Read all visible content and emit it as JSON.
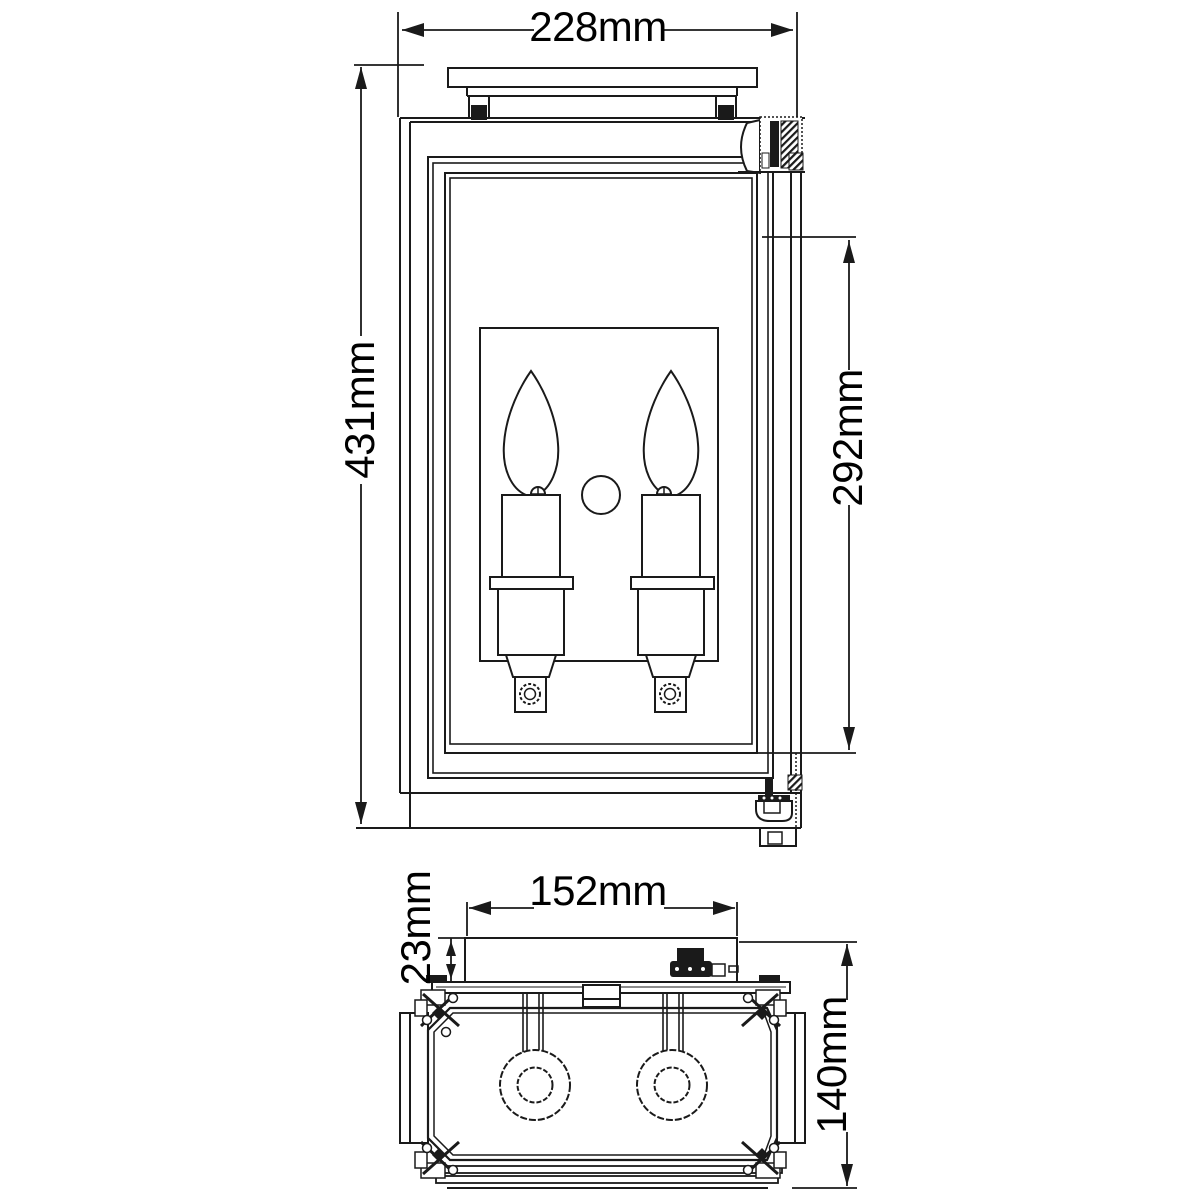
{
  "drawing": {
    "type": "technical-dimension-drawing",
    "subject": "two-light wall lantern fixture",
    "views": {
      "front": {
        "name": "front-elevation",
        "dimensions": [
          {
            "id": "overall_width",
            "label": "228mm",
            "value_mm": 228,
            "orientation": "horizontal"
          },
          {
            "id": "overall_height",
            "label": "431mm",
            "value_mm": 431,
            "orientation": "vertical"
          },
          {
            "id": "glass_height",
            "label": "292mm",
            "value_mm": 292,
            "orientation": "vertical"
          }
        ]
      },
      "top": {
        "name": "top-plan",
        "dimensions": [
          {
            "id": "backplate_width",
            "label": "152mm",
            "value_mm": 152,
            "orientation": "horizontal"
          },
          {
            "id": "backplate_depth",
            "label": "23mm",
            "value_mm": 23,
            "orientation": "vertical"
          },
          {
            "id": "overall_depth",
            "label": "140mm",
            "value_mm": 140,
            "orientation": "vertical"
          }
        ]
      }
    },
    "colors": {
      "line": "#1a1a1a",
      "background": "#ffffff",
      "text": "#000000"
    }
  }
}
